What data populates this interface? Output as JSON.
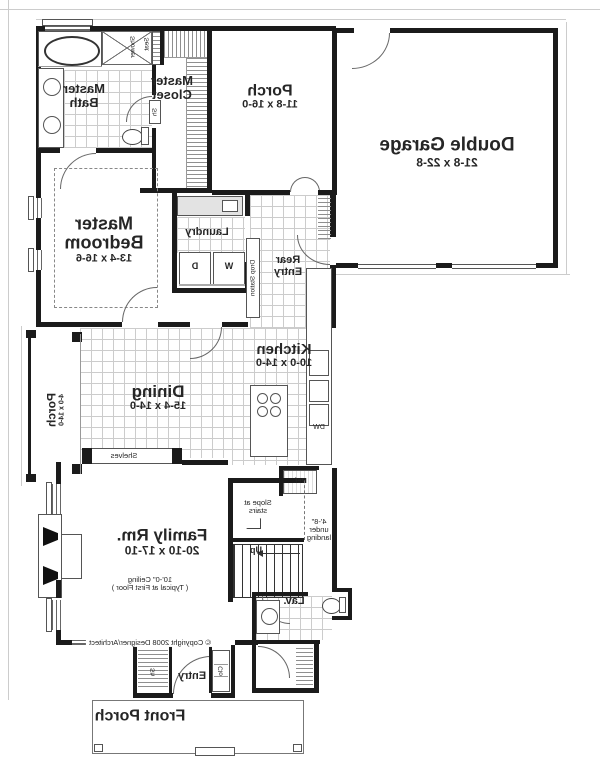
{
  "plan_type": "first-floor-plan-mirrored",
  "colors": {
    "wall": "#1b1b1b",
    "thin_line": "#666",
    "hatch": "#8f8f8f",
    "tile_grid": "#cccccc",
    "text": "#262626"
  },
  "rooms": {
    "master_bath": {
      "label": "Master Bath"
    },
    "master_closet": {
      "label": "Master Closet"
    },
    "rear_porch": {
      "label": "Porch",
      "dims": "11-8 x 16-0"
    },
    "garage": {
      "label": "Double Garage",
      "dims": "21-8 x 22-8"
    },
    "master_bedroom": {
      "label": "Master Bedroom",
      "dims": "13-4 x 16-6"
    },
    "laundry": {
      "label": "Laundry"
    },
    "rear_entry": {
      "label": "Rear Entry"
    },
    "kitchen": {
      "label": "Kitchen",
      "dims": "10-0 x 14-0"
    },
    "dining": {
      "label": "Dining",
      "dims": "15-4 x 14-0"
    },
    "side_porch": {
      "label": "Porch",
      "dims": "4-0 x 14-0"
    },
    "family_room": {
      "label": "Family Rm.",
      "dims": "20-10 x 17-10",
      "ceiling_note_1": "10'-0\" Ceiling",
      "ceiling_note_2": "( Typical at First Floor )"
    },
    "lav": {
      "label": "Lav."
    },
    "entry": {
      "label": "Entry"
    },
    "front_porch": {
      "label": "Front Porch"
    }
  },
  "annotations": {
    "shower": "Shower",
    "seat": "Seat",
    "shelf_abbr": "Sh",
    "washer": "W",
    "dryer": "D",
    "dishwasher": "DW",
    "fridge": "Ref.",
    "drop_station": "Drop Station",
    "shelves": "Shelves",
    "slope": "Slope at stairs",
    "under_landing": "4'-8\" under landing",
    "up": "Up",
    "entry_shelf": "Sh",
    "entry_closet": "Clo",
    "copyright": "© Copyright 2008 Designer/Architect"
  }
}
